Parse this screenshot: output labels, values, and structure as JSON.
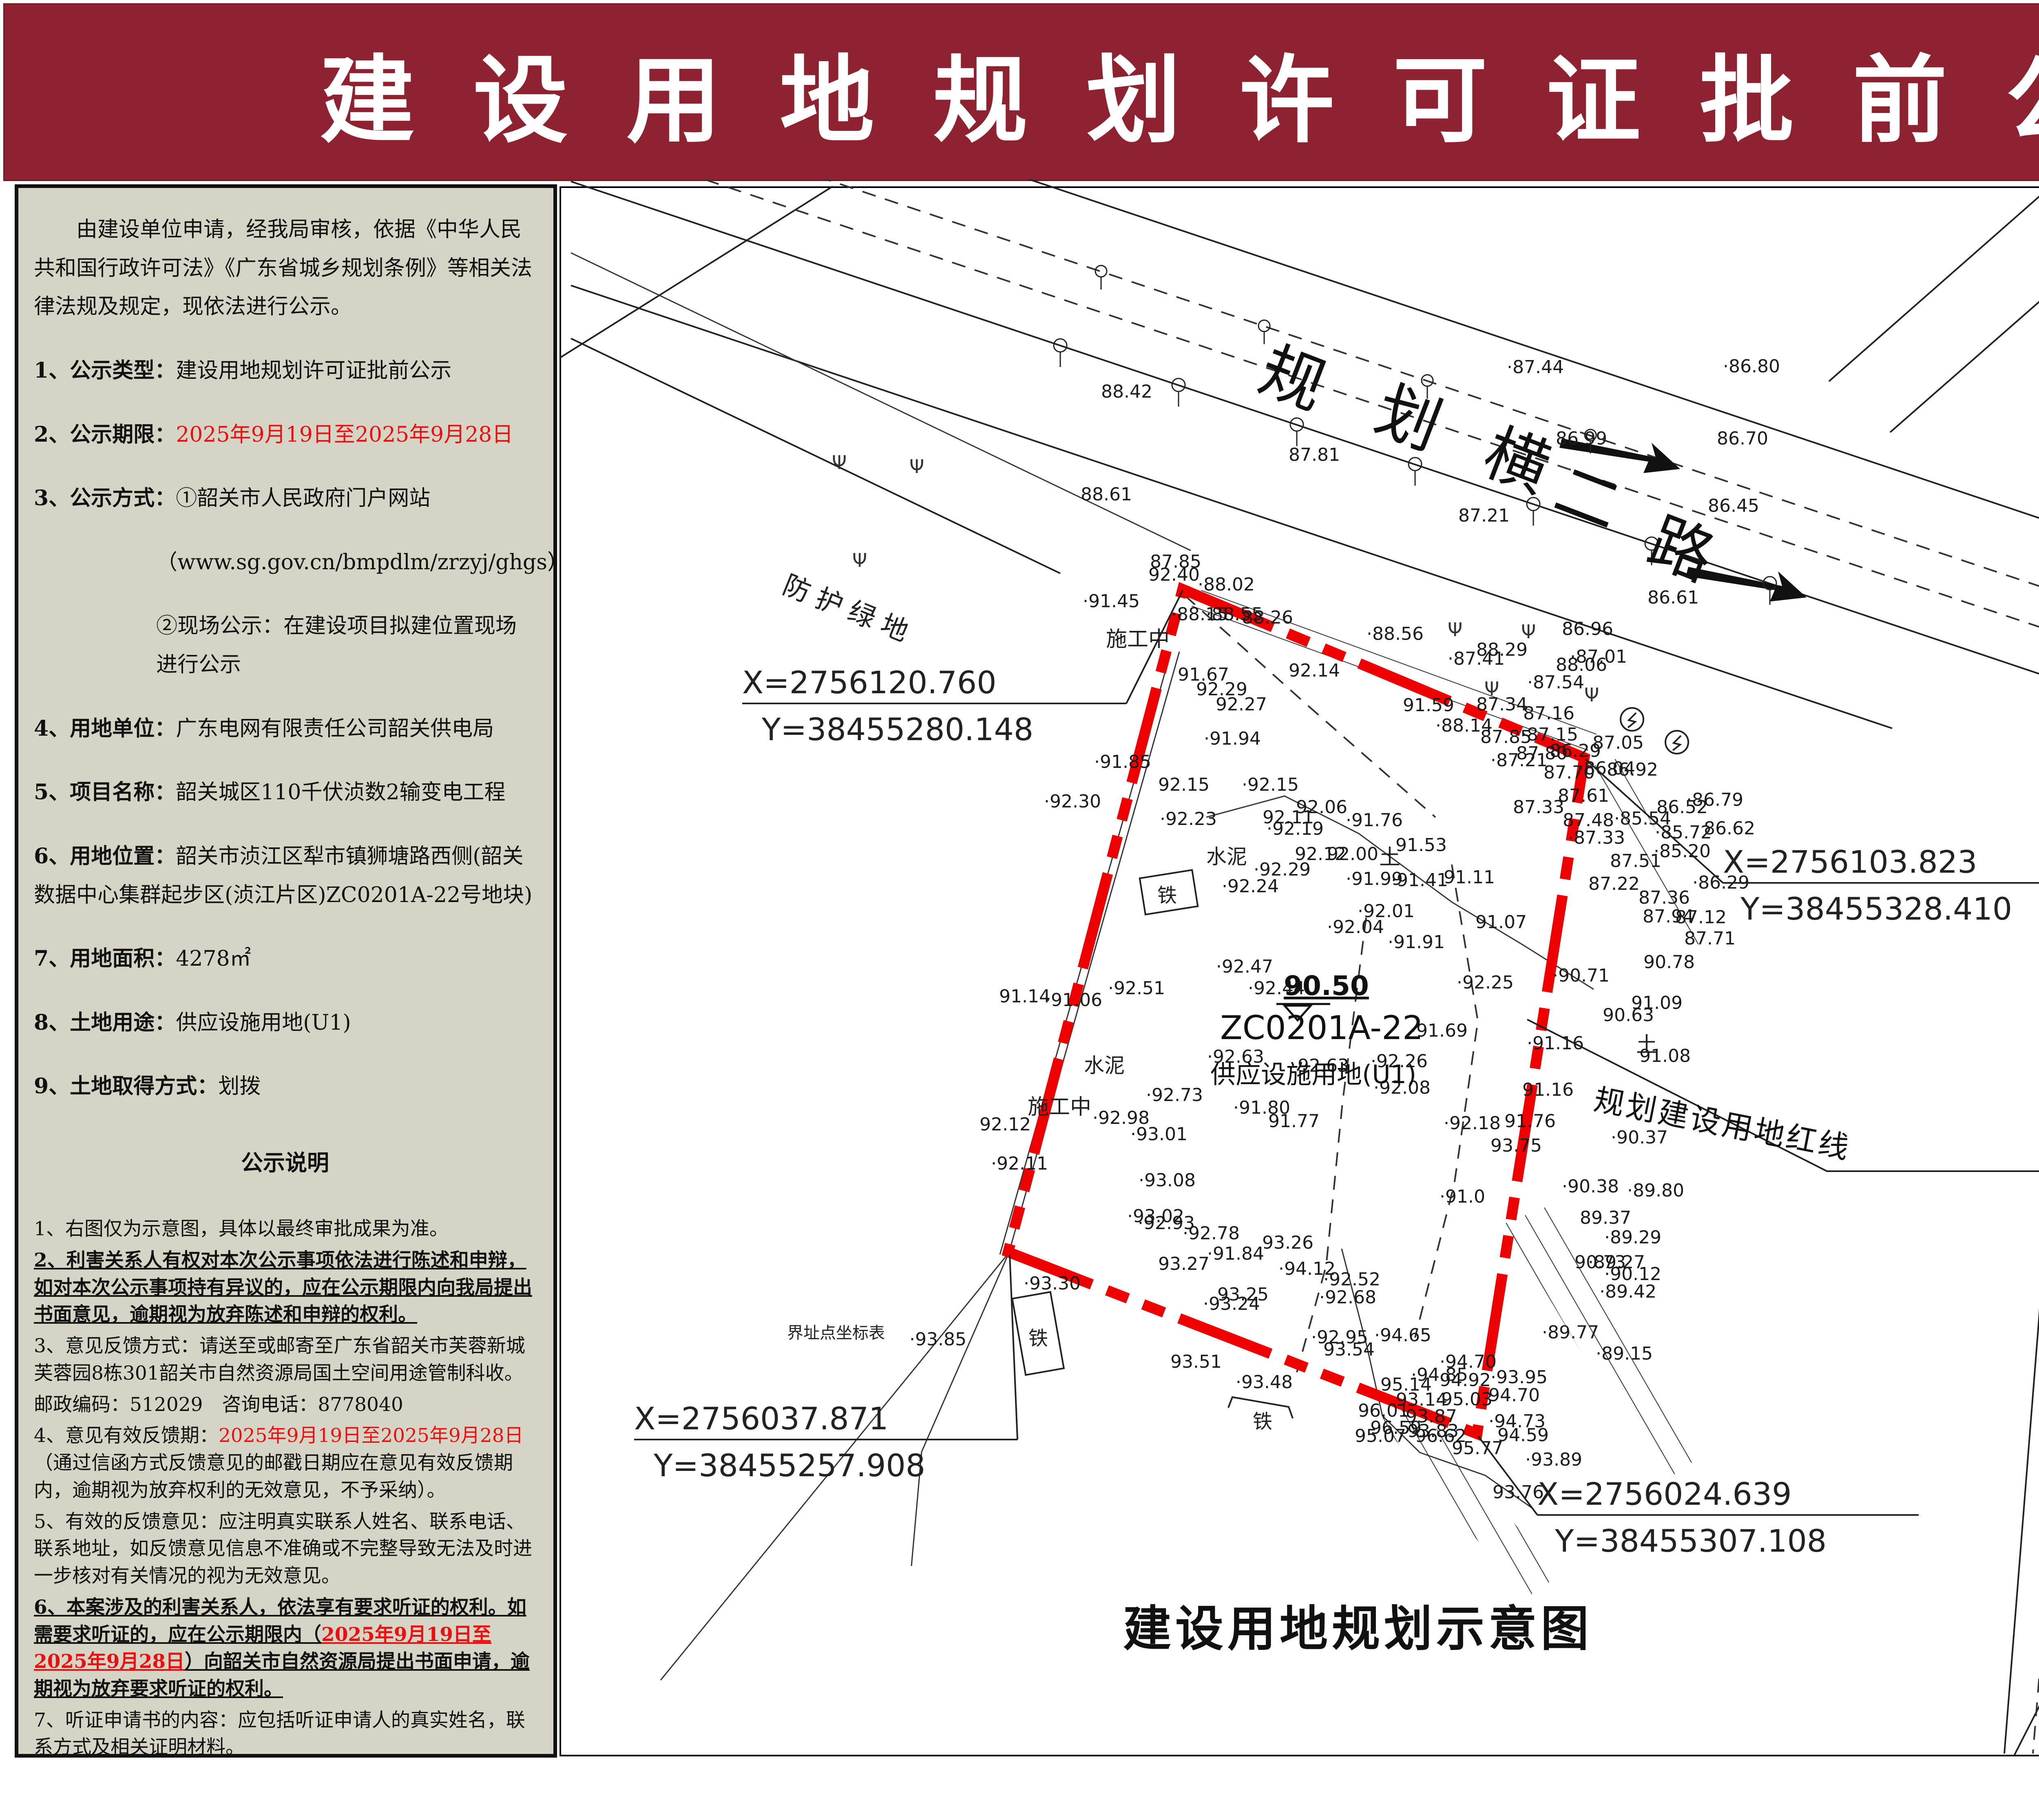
{
  "banner": {
    "title": "建设用地规划许可证批前公示"
  },
  "notice": {
    "paragraphs": [
      {
        "st": "top ind",
        "s": [
          {
            "t": "由建设单位申请，经我局审核，依据《中华人民共和国行政许可法》《广东省城乡规划条例》等相关法律法规及规定，现依法进行公示。"
          }
        ]
      },
      {
        "st": "top",
        "s": [
          {
            "t": "1、公示类型：",
            "b": 1
          },
          {
            "t": "建设用地规划许可证批前公示"
          }
        ]
      },
      {
        "st": "top",
        "s": [
          {
            "t": "2、公示期限：",
            "b": 1
          },
          {
            "t": "2025年9月19日至2025年9月28日",
            "r": 1
          }
        ]
      },
      {
        "st": "top",
        "s": [
          {
            "t": "3、公示方式：",
            "b": 1
          },
          {
            "t": "①韶关市人民政府门户网站"
          }
        ]
      },
      {
        "st": "top sub",
        "s": [
          {
            "t": "（www.sg.gov.cn/bmpdlm/zrzyj/ghgs）"
          }
        ]
      },
      {
        "st": "top sub",
        "s": [
          {
            "t": "②现场公示：在建设项目拟建位置现场进行公示"
          }
        ]
      },
      {
        "st": "top",
        "s": [
          {
            "t": "4、用地单位：",
            "b": 1
          },
          {
            "t": "广东电网有限责任公司韶关供电局"
          }
        ]
      },
      {
        "st": "top",
        "s": [
          {
            "t": "5、项目名称：",
            "b": 1
          },
          {
            "t": "韶关城区110千伏浈数2输变电工程"
          }
        ]
      },
      {
        "st": "top",
        "s": [
          {
            "t": "6、用地位置：",
            "b": 1
          },
          {
            "t": "韶关市浈江区犁市镇狮塘路西侧(韶关数据中心集群起步区(浈江片区)ZC0201A-22号地块)"
          }
        ]
      },
      {
        "st": "top",
        "s": [
          {
            "t": "7、用地面积：",
            "b": 1
          },
          {
            "t": "4278㎡"
          }
        ]
      },
      {
        "st": "top",
        "s": [
          {
            "t": "8、土地用途：",
            "b": 1
          },
          {
            "t": "供应设施用地(U1)"
          }
        ]
      },
      {
        "st": "top",
        "s": [
          {
            "t": "9、土地取得方式：",
            "b": 1
          },
          {
            "t": "划拨"
          }
        ]
      },
      {
        "st": "ctr",
        "s": [
          {
            "t": "公示说明",
            "b": 1
          }
        ]
      },
      {
        "st": "bot",
        "s": [
          {
            "t": "1、右图仅为示意图，具体以最终审批成果为准。"
          }
        ]
      },
      {
        "st": "bot",
        "s": [
          {
            "t": "2、利害关系人有权对本次公示事项依法进行陈述和申辩，如对本次公示事项持有异议的，应在公示期限内向我局提出书面意见，逾期视为放弃陈述和申辩的权利。",
            "b": 1,
            "u": 1
          }
        ]
      },
      {
        "st": "bot",
        "s": [
          {
            "t": "3、意见反馈方式：请送至或邮寄至广东省韶关市芙蓉新城芙蓉园8栋301韶关市自然资源局国土空间用途管制科收。"
          }
        ]
      },
      {
        "st": "bot",
        "s": [
          {
            "t": "邮政编码：512029　咨询电话：8778040"
          }
        ]
      },
      {
        "st": "bot",
        "s": [
          {
            "t": "4、意见有效反馈期："
          },
          {
            "t": "2025年9月19日至2025年9月28日",
            "r": 1
          },
          {
            "t": "（通过信函方式反馈意见的邮戳日期应在意见有效反馈期内，逾期视为放弃权利的无效意见，不予采纳）。"
          }
        ]
      },
      {
        "st": "bot",
        "s": [
          {
            "t": "5、有效的反馈意见：应注明真实联系人姓名、联系电话、联系地址，如反馈意见信息不准确或不完整导致无法及时进一步核对有关情况的视为无效意见。"
          }
        ]
      },
      {
        "st": "bot",
        "s": [
          {
            "t": "6、本案涉及的利害关系人，依法享有要求听证的权利。如需要求听证的，应在公示期限内（",
            "b": 1,
            "u": 1
          },
          {
            "t": "2025年9月19日至2025年9月28日",
            "b": 1,
            "u": 1,
            "r": 1
          },
          {
            "t": "）向韶关市自然资源局提出书面申请，逾期视为放弃要求听证的权利。",
            "b": 1,
            "u": 1
          }
        ]
      },
      {
        "st": "bot",
        "s": [
          {
            "t": "7、听证申请书的内容：应包括听证申请人的真实姓名，联系方式及相关证明材料。"
          }
        ]
      },
      {
        "st": "bot rt",
        "s": [
          {
            "t": "韶关市自然资源局"
          }
        ]
      },
      {
        "st": "bot rt",
        "s": [
          {
            "t": "2025年9月19日",
            "r": 1
          }
        ]
      }
    ]
  },
  "map": {
    "caption": "建设用地规划示意图",
    "parcel_code": "ZC0201A-22",
    "parcel_use": "供应设施用地(U1)",
    "redline_label": "规划建设用地红线",
    "benchmark": "90.50",
    "road_main": "规划横二路",
    "road_side": "狮塘路",
    "green_label": "防护绿地",
    "corner_coords": [
      {
        "x": "X=2756120.760",
        "y": "Y=38455280.148"
      },
      {
        "x": "X=2756103.823",
        "y": "Y=38455328.410"
      },
      {
        "x": "X=2756037.871",
        "y": "Y=38455257.908"
      },
      {
        "x": "X=2756024.639",
        "y": "Y=38455307.108"
      }
    ],
    "site_labels": [
      "施工中",
      "施工中",
      "水泥",
      "水泥",
      "铁",
      "铁",
      "铁",
      "土",
      "土",
      "界址点坐标表"
    ],
    "spot_elevations": [
      [
        2700,
        975,
        "88.42"
      ],
      [
        3695,
        915,
        "·87.44"
      ],
      [
        4225,
        913,
        "·86.80"
      ],
      [
        3160,
        1130,
        "87.81"
      ],
      [
        3815,
        1090,
        "86.99"
      ],
      [
        4210,
        1090,
        "86.70"
      ],
      [
        2650,
        1227,
        "88.61"
      ],
      [
        2820,
        1392,
        "87.85"
      ],
      [
        2937,
        1448,
        "·88.02"
      ],
      [
        2872,
        1521,
        "·88.15"
      ],
      [
        3576,
        1279,
        "87.21"
      ],
      [
        4188,
        1255,
        "86.45"
      ],
      [
        4040,
        1480,
        "86.61"
      ],
      [
        3830,
        1557,
        "86.96"
      ],
      [
        3550,
        1630,
        "·87.41"
      ],
      [
        3850,
        1625,
        "·87.01"
      ],
      [
        3620,
        1608,
        "88.29"
      ],
      [
        3815,
        1645,
        "88.06"
      ],
      [
        3745,
        1688,
        "·87.54"
      ],
      [
        2816,
        1424,
        "92.40"
      ],
      [
        2655,
        1489,
        "·91.45"
      ],
      [
        2957,
        1521,
        "·88.55"
      ],
      [
        3045,
        1529,
        "88.26"
      ],
      [
        3351,
        1569,
        "·88.56"
      ],
      [
        2888,
        1669,
        "91.67"
      ],
      [
        2933,
        1705,
        "92.29"
      ],
      [
        2981,
        1742,
        "92.27"
      ],
      [
        2952,
        1826,
        "·91.94"
      ],
      [
        3160,
        1659,
        "92.14"
      ],
      [
        3440,
        1744,
        "91.59"
      ],
      [
        2560,
        1980,
        "·92.30"
      ],
      [
        2683,
        1883,
        "·91.85"
      ],
      [
        2840,
        1939,
        "92.15"
      ],
      [
        3045,
        1939,
        "·92.15"
      ],
      [
        2844,
        2023,
        "·92.23"
      ],
      [
        3106,
        2047,
        "·92.19"
      ],
      [
        3074,
        2147,
        "·92.29"
      ],
      [
        3178,
        1994,
        "92.06"
      ],
      [
        3096,
        2019,
        "92.11"
      ],
      [
        3300,
        2026,
        "·91.76"
      ],
      [
        3422,
        2087,
        "91.53"
      ],
      [
        3411,
        2173,
        "·91.41"
      ],
      [
        3175,
        2109,
        "92.12"
      ],
      [
        3254,
        2109,
        "92.00"
      ],
      [
        3300,
        2170,
        "·91.99"
      ],
      [
        2996,
        2188,
        "·92.24"
      ],
      [
        3329,
        2249,
        "·92.01"
      ],
      [
        3254,
        2288,
        "·92.04"
      ],
      [
        2982,
        2385,
        "·92.47"
      ],
      [
        3060,
        2438,
        "·92.44"
      ],
      [
        2717,
        2438,
        "·92.51"
      ],
      [
        2563,
        2467,
        "·91.06"
      ],
      [
        2960,
        2606,
        "·92.63"
      ],
      [
        3182,
        2628,
        "92.63"
      ],
      [
        3361,
        2617,
        "·92.26"
      ],
      [
        3368,
        2682,
        "·92.08"
      ],
      [
        2810,
        2700,
        "·92.73"
      ],
      [
        2450,
        2458,
        "91.14"
      ],
      [
        2402,
        2772,
        "92.12"
      ],
      [
        2430,
        2868,
        "·92.11"
      ],
      [
        2679,
        2756,
        "·92.98"
      ],
      [
        2772,
        2796,
        "·93.01"
      ],
      [
        2792,
        2909,
        "·93.08"
      ],
      [
        2764,
        2997,
        "·93.02"
      ],
      [
        3403,
        2325,
        "·91.91"
      ],
      [
        3807,
        2407,
        "·90.71"
      ],
      [
        4030,
        2374,
        "90.78"
      ],
      [
        3572,
        2424,
        "·92.25"
      ],
      [
        3744,
        2573,
        "·91.16"
      ],
      [
        4000,
        2474,
        "91.09"
      ],
      [
        3930,
        2504,
        "90.63"
      ],
      [
        4020,
        2604,
        "91.08"
      ],
      [
        3950,
        2804,
        "·90.37"
      ],
      [
        3830,
        2924,
        "·90.38"
      ],
      [
        3459,
        2542,
        "·91.69"
      ],
      [
        3530,
        2949,
        "·91.0"
      ],
      [
        3861,
        3110,
        "90.73"
      ],
      [
        3934,
        3139,
        "·90.12"
      ],
      [
        3024,
        2731,
        "·91.80"
      ],
      [
        3110,
        2764,
        "91.77"
      ],
      [
        3689,
        2764,
        "91.76"
      ],
      [
        3733,
        2687,
        "91.16"
      ],
      [
        3540,
        2769,
        "·92.18"
      ],
      [
        3655,
        2824,
        "93.75"
      ],
      [
        3990,
        2934,
        "·89.80"
      ],
      [
        2790,
        3014,
        "·92.93"
      ],
      [
        2900,
        3039,
        "·92.78"
      ],
      [
        2960,
        3089,
        "·91.84"
      ],
      [
        3874,
        3001,
        "89.37"
      ],
      [
        3934,
        3049,
        "·89.29"
      ],
      [
        3894,
        3110,
        "·89.27"
      ],
      [
        3922,
        3182,
        "·89.42"
      ],
      [
        3781,
        3282,
        "·89.77"
      ],
      [
        3913,
        3334,
        "·89.15"
      ],
      [
        2840,
        3114,
        "93.27"
      ],
      [
        2510,
        3162,
        "·93.30"
      ],
      [
        2950,
        3212,
        "·93.24"
      ],
      [
        2985,
        3189,
        "93.25"
      ],
      [
        3095,
        3062,
        "93.26"
      ],
      [
        3135,
        3126,
        "·94.12"
      ],
      [
        3245,
        3152,
        "·92.52"
      ],
      [
        3235,
        3196,
        "·92.68"
      ],
      [
        3215,
        3294,
        "·92.95"
      ],
      [
        2230,
        3299,
        "·93.85"
      ],
      [
        3245,
        3324,
        "93.54"
      ],
      [
        2870,
        3354,
        "93.51"
      ],
      [
        3030,
        3404,
        "·93.48"
      ],
      [
        3370,
        3289,
        "·94.65"
      ],
      [
        3530,
        3354,
        "·94.70"
      ],
      [
        3460,
        3386,
        "·94.85"
      ],
      [
        3530,
        3399,
        "94.92"
      ],
      [
        3655,
        3392,
        "·93.95"
      ],
      [
        3385,
        3410,
        "95.14"
      ],
      [
        3520,
        3446,
        "·95.03"
      ],
      [
        3650,
        3436,
        "94.70"
      ],
      [
        3330,
        3474,
        "96.01"
      ],
      [
        3360,
        3516,
        "96.59"
      ],
      [
        3470,
        3536,
        "96.62"
      ],
      [
        3560,
        3566,
        "95.77"
      ],
      [
        3650,
        3500,
        "·94.73"
      ],
      [
        3672,
        3534,
        "94.59"
      ],
      [
        3423,
        3447,
        "93.14"
      ],
      [
        3447,
        3488,
        "93.87"
      ],
      [
        3451,
        3524,
        "93.83"
      ],
      [
        3322,
        3536,
        "95.07"
      ],
      [
        3740,
        3594,
        "·93.89"
      ],
      [
        3660,
        3674,
        "93.76"
      ],
      [
        3618,
        2276,
        "91.07"
      ],
      [
        3540,
        2166,
        "91.11"
      ],
      [
        3905,
        1836,
        "87.05"
      ],
      [
        3735,
        1764,
        "87.16"
      ],
      [
        3520,
        1794,
        "·88.14"
      ],
      [
        3730,
        1816,
        "·87.15"
      ],
      [
        3630,
        1822,
        "87.85"
      ],
      [
        3718,
        1862,
        "87.80"
      ],
      [
        3800,
        1856,
        "86.29"
      ],
      [
        3655,
        1879,
        "·87.21"
      ],
      [
        3785,
        1909,
        "87.70"
      ],
      [
        3870,
        1899,
        "·86.04"
      ],
      [
        3940,
        1902,
        "86.92"
      ],
      [
        3820,
        1966,
        "87.61"
      ],
      [
        3710,
        1994,
        "87.33"
      ],
      [
        3832,
        2026,
        "87.48"
      ],
      [
        3845,
        2069,
        "·87.33"
      ],
      [
        3958,
        2022,
        "·85.54"
      ],
      [
        4062,
        1994,
        "86.52"
      ],
      [
        4135,
        1976,
        "·86.79"
      ],
      [
        4058,
        2056,
        "·85.72"
      ],
      [
        4178,
        2046,
        "86.62"
      ],
      [
        4055,
        2102,
        "·85.20"
      ],
      [
        3948,
        2126,
        "87.51"
      ],
      [
        3895,
        2182,
        "87.22"
      ],
      [
        4150,
        2179,
        "·86.29"
      ],
      [
        4018,
        2216,
        "87.36"
      ],
      [
        4028,
        2262,
        "87.94"
      ],
      [
        4108,
        2264,
        "87.12"
      ],
      [
        4130,
        2316,
        "87.71"
      ],
      [
        3620,
        1742,
        "87.34"
      ]
    ]
  },
  "right_panel": {
    "north_label": "N",
    "legend_title": "图例",
    "legend_item": "规划建设用地红线",
    "location_title": "位置示意图",
    "location_roads": [
      "规划纵二路",
      "规划横二路",
      "狮塘路",
      "皇岗大道北"
    ],
    "project_label": "项目位置",
    "supervisor": "监制单位：韶关市自然资源局"
  },
  "colors": {
    "banner": "#8e2230",
    "panel_bg": "#d4d5c5",
    "redline": "#ee0000",
    "date_red": "#ed0f0f"
  }
}
